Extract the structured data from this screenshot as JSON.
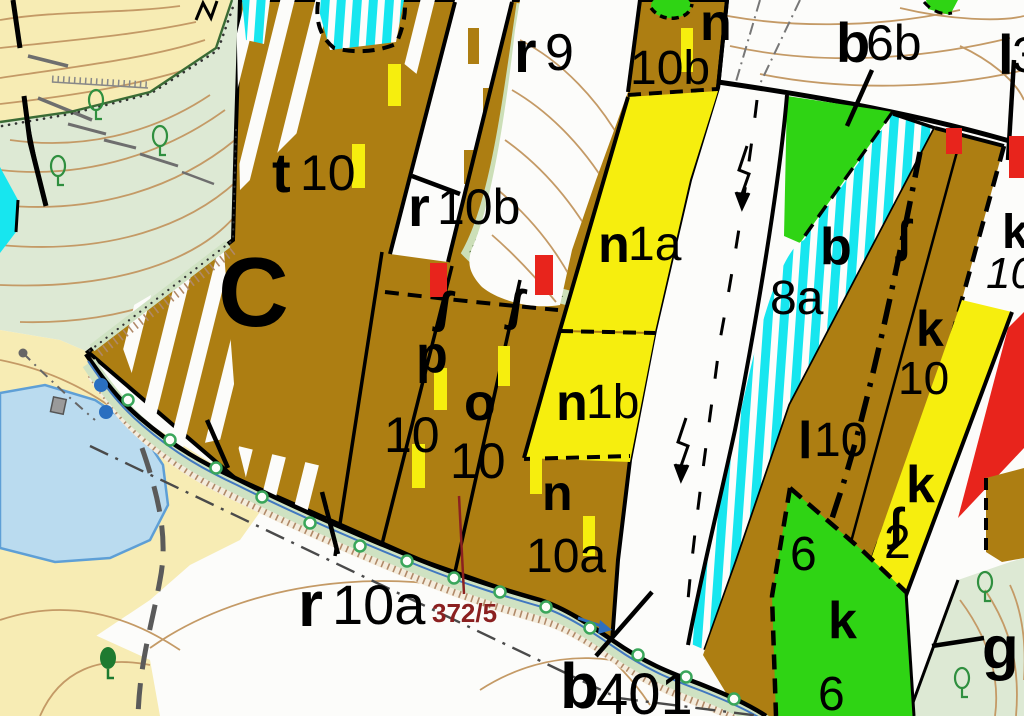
{
  "map": {
    "colors": {
      "brown": "#ad7e12",
      "yellow": "#f6ee0e",
      "green": "#2fd414",
      "cyan": "#17e6ef",
      "red": "#e8241c",
      "pale_yellow": "#f7ecb4",
      "pale_green": "#dde9d4",
      "band_green": "#cfe2c2",
      "lake_blue": "#badbef",
      "white": "#fcfcfa",
      "contour_tan": "#c49a66",
      "annotation_red": "#8b2020"
    },
    "labels": [
      {
        "id": "c",
        "parts": [
          {
            "t": "C",
            "x": 218,
            "y": 326,
            "size": 98,
            "bold": true
          }
        ]
      },
      {
        "id": "t10",
        "parts": [
          {
            "t": "t",
            "x": 272,
            "y": 192,
            "size": 56,
            "bold": true
          },
          {
            "t": "10",
            "x": 300,
            "y": 190,
            "size": 50
          }
        ]
      },
      {
        "id": "r9",
        "parts": [
          {
            "t": "r",
            "x": 514,
            "y": 72,
            "size": 58,
            "bold": true
          },
          {
            "t": "9",
            "x": 545,
            "y": 70,
            "size": 52
          }
        ]
      },
      {
        "id": "r10b",
        "parts": [
          {
            "t": "r",
            "x": 408,
            "y": 226,
            "size": 56,
            "bold": true
          },
          {
            "t": "10b",
            "x": 437,
            "y": 224,
            "size": 50
          }
        ]
      },
      {
        "id": "p10",
        "parts": [
          {
            "t": "p",
            "x": 416,
            "y": 372,
            "size": 52,
            "bold": true
          },
          {
            "t": "10",
            "x": 384,
            "y": 452,
            "size": 50
          }
        ]
      },
      {
        "id": "o10",
        "parts": [
          {
            "t": "o",
            "x": 464,
            "y": 420,
            "size": 52,
            "bold": true
          },
          {
            "t": "10",
            "x": 450,
            "y": 478,
            "size": 50
          }
        ]
      },
      {
        "id": "n10a",
        "parts": [
          {
            "t": "n",
            "x": 542,
            "y": 510,
            "size": 50,
            "bold": true
          },
          {
            "t": "10a",
            "x": 526,
            "y": 572,
            "size": 48
          }
        ]
      },
      {
        "id": "n10b",
        "parts": [
          {
            "t": "n",
            "x": 700,
            "y": 40,
            "size": 52,
            "bold": true
          },
          {
            "t": "10b",
            "x": 630,
            "y": 84,
            "size": 48
          }
        ]
      },
      {
        "id": "n1a",
        "parts": [
          {
            "t": "n",
            "x": 598,
            "y": 262,
            "size": 52,
            "bold": true
          },
          {
            "t": "1a",
            "x": 628,
            "y": 260,
            "size": 48
          }
        ]
      },
      {
        "id": "n1b",
        "parts": [
          {
            "t": "n",
            "x": 556,
            "y": 420,
            "size": 52,
            "bold": true
          },
          {
            "t": "1b",
            "x": 586,
            "y": 418,
            "size": 48
          }
        ]
      },
      {
        "id": "b8a",
        "parts": [
          {
            "t": "b",
            "x": 820,
            "y": 264,
            "size": 52,
            "bold": true
          },
          {
            "t": "8a",
            "x": 770,
            "y": 314,
            "size": 48
          }
        ]
      },
      {
        "id": "b6b",
        "parts": [
          {
            "t": "b",
            "x": 836,
            "y": 62,
            "size": 56,
            "bold": true
          },
          {
            "t": "6b",
            "x": 866,
            "y": 60,
            "size": 50
          }
        ]
      },
      {
        "id": "l3",
        "parts": [
          {
            "t": "l",
            "x": 998,
            "y": 74,
            "size": 56,
            "bold": true
          },
          {
            "t": "3",
            "x": 1012,
            "y": 72,
            "size": 50
          }
        ]
      },
      {
        "id": "l10",
        "parts": [
          {
            "t": "l",
            "x": 798,
            "y": 458,
            "size": 52,
            "bold": true
          },
          {
            "t": "10",
            "x": 814,
            "y": 456,
            "size": 48
          }
        ]
      },
      {
        "id": "k10-brown",
        "parts": [
          {
            "t": "k",
            "x": 916,
            "y": 346,
            "size": 50,
            "bold": true
          },
          {
            "t": "10",
            "x": 898,
            "y": 394,
            "size": 46
          }
        ]
      },
      {
        "id": "k10-white",
        "parts": [
          {
            "t": "k",
            "x": 1002,
            "y": 248,
            "size": 48,
            "bold": true
          },
          {
            "t": "10",
            "x": 986,
            "y": 288,
            "size": 44,
            "italic": true
          }
        ]
      },
      {
        "id": "k2",
        "parts": [
          {
            "t": "k",
            "x": 906,
            "y": 502,
            "size": 52,
            "bold": true
          },
          {
            "t": "2",
            "x": 884,
            "y": 558,
            "size": 48
          }
        ]
      },
      {
        "id": "k6",
        "parts": [
          {
            "t": "6",
            "x": 790,
            "y": 570,
            "size": 48
          },
          {
            "t": "k",
            "x": 828,
            "y": 638,
            "size": 52,
            "bold": true
          },
          {
            "t": "6",
            "x": 818,
            "y": 710,
            "size": 48
          }
        ]
      },
      {
        "id": "g",
        "parts": [
          {
            "t": "g",
            "x": 982,
            "y": 668,
            "size": 60,
            "bold": true
          }
        ]
      },
      {
        "id": "r10a",
        "parts": [
          {
            "t": "r",
            "x": 298,
            "y": 626,
            "size": 64,
            "bold": true
          },
          {
            "t": "10a",
            "x": 332,
            "y": 624,
            "size": 56
          }
        ]
      },
      {
        "id": "b401",
        "parts": [
          {
            "t": "b",
            "x": 560,
            "y": 708,
            "size": 64,
            "bold": true
          },
          {
            "t": "401",
            "x": 596,
            "y": 714,
            "size": 58
          }
        ]
      },
      {
        "id": "parcel-372-5",
        "parts": [
          {
            "t": "372/5",
            "x": 432,
            "y": 622,
            "size": 26,
            "bold": true,
            "color": "#8b2020"
          }
        ]
      }
    ],
    "symbols": {
      "yellow_marks": [
        [
          388,
          64,
          13,
          42
        ],
        [
          352,
          144,
          13,
          44
        ],
        [
          681,
          28,
          12,
          44
        ],
        [
          434,
          368,
          13,
          42
        ],
        [
          498,
          346,
          12,
          40
        ],
        [
          412,
          444,
          13,
          44
        ],
        [
          530,
          454,
          12,
          40
        ],
        [
          583,
          516,
          12,
          40
        ]
      ],
      "red_marks": [
        [
          430,
          263,
          17,
          34
        ],
        [
          535,
          255,
          18,
          40
        ],
        [
          946,
          128,
          16,
          26
        ],
        [
          1009,
          136,
          15,
          42
        ]
      ],
      "hooks": [
        {
          "t": "ʃ",
          "x": 434,
          "y": 322,
          "rot": 8
        },
        {
          "t": "ʃ",
          "x": 506,
          "y": 320,
          "rot": 8
        },
        {
          "t": "ʃ",
          "x": 896,
          "y": 252,
          "rot": 0
        },
        {
          "t": "ʃ",
          "x": 888,
          "y": 540,
          "rot": 0
        }
      ],
      "stream_circles": [
        [
          128,
          400
        ],
        [
          170,
          440
        ],
        [
          216,
          468
        ],
        [
          262,
          497
        ],
        [
          310,
          523
        ],
        [
          360,
          546
        ],
        [
          407,
          561
        ],
        [
          454,
          578
        ],
        [
          500,
          592
        ],
        [
          546,
          607
        ],
        [
          590,
          628
        ],
        [
          638,
          655
        ],
        [
          686,
          677
        ],
        [
          734,
          699
        ]
      ],
      "trees_outline": [
        [
          96,
          100
        ],
        [
          160,
          136
        ],
        [
          58,
          166
        ],
        [
          985,
          582
        ],
        [
          962,
          678
        ]
      ],
      "trees_filled": [
        [
          108,
          658
        ]
      ],
      "blue_dots": [
        [
          101,
          385
        ],
        [
          106,
          412
        ]
      ]
    }
  }
}
